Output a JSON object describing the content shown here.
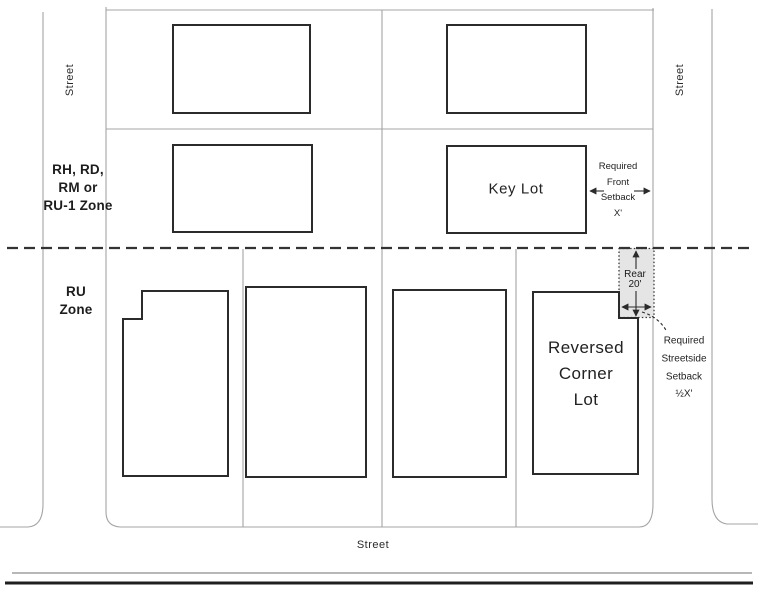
{
  "diagram_type": "zoning-setback-diagram",
  "labels": {
    "street_left": "Street",
    "street_right": "Street",
    "street_bottom": "Street",
    "upper_zone": [
      "RH, RD,",
      "RM or",
      "RU-1 Zone"
    ],
    "lower_zone": [
      "RU",
      "Zone"
    ],
    "key_lot": "Key Lot",
    "reversed_corner_lot": [
      "Reversed",
      "Corner",
      "Lot"
    ],
    "front_setback": [
      "Required",
      "Front",
      "Setback",
      "X'"
    ],
    "rear_setback": [
      "Rear",
      "20'"
    ],
    "streetside_setback": [
      "Required",
      "Streetside",
      "Setback",
      "½X'"
    ]
  },
  "colors": {
    "background": "#ffffff",
    "parcel_line": "#a4a4a4",
    "building_line": "#2b2b2b",
    "zone_boundary_line": "#333333",
    "setback_shading": "#e5e5e5",
    "annotation_ink": "#222222"
  }
}
